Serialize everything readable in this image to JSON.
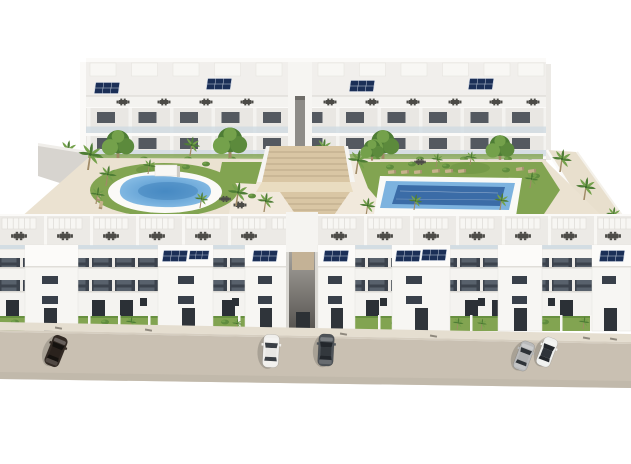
{
  "meta": {
    "image_type": "3d-architectural-render",
    "subject": "Aerial view of a white modern residential apartment complex with communal courtyard, two swimming pools, palm trees, rooftop solar panels and a street with parked cars",
    "text_visible": false
  },
  "colors": {
    "background": "#ffffff",
    "building": "#f4f3f0",
    "buildingShade": "#e7e5e1",
    "windowDark": "#3a4149",
    "glassRail": "#cdd9e2",
    "solarPanel": "#1b2f57",
    "furniture": "#4c4b47",
    "sand": "#ebe2d1",
    "lawn": "#82a451",
    "palm": "#4e7d35",
    "palmLight": "#74a14b",
    "trunk": "#a08a66",
    "poolLight": "#8fc2e8",
    "poolMid": "#4f93cc",
    "poolDeep": "#2f5f9e",
    "stairs": "#d9c6a4",
    "road": "#c9c0b2",
    "sidewalk": "#e5ded0",
    "carDarkBrown": "#332a24",
    "carWhite": "#f0efec",
    "carGrey": "#4e5358",
    "carSilver": "#b9babb"
  },
  "scene": {
    "rear_building": {
      "floors": 3,
      "roof": "rooftop terraces with pergolas, dark outdoor furniture sets and 4 solar panel clusters",
      "facade": "white with glass balustrade balconies and dark ribbon windows",
      "base": "hedge row, round trees and palm trees",
      "central_opening": "entrance gap aligned with courtyard staircase"
    },
    "courtyard": {
      "ground": "sand-beige paving with green lawns",
      "pools": [
        {
          "name": "left-pool",
          "shape": "freeform oval",
          "water": "light blue"
        },
        {
          "name": "right-pool",
          "shape": "rectangular",
          "water": "deep blue with light rim",
          "sun_loungers": 8
        }
      ],
      "central_staircase": "wide tan terraced steps connecting rear building to front passage",
      "vegetation": "many palm trees, bushes and lawn patches",
      "pool_bar": 1
    },
    "front_buildings": {
      "blocks": 2,
      "separated_by": "central pedestrian passage",
      "floors": 3,
      "roof": "courtyard-facing terraces with pergolas and furniture",
      "stair_towers_with_solar_panels": 6,
      "street_facade": "white with two dark ribbon-window bands and recessed doorways",
      "street_level": "private patios with grass, small palms and white fences"
    },
    "street": {
      "surface": "beige asphalt with sidewalk and curb",
      "cars": [
        {
          "color": "dark brown",
          "position": "left",
          "orientation": "diagonal"
        },
        {
          "color": "white",
          "position": "center-left",
          "orientation": "vertical"
        },
        {
          "color": "dark grey",
          "position": "center",
          "orientation": "vertical"
        },
        {
          "color": "silver",
          "position": "right pair",
          "orientation": "diagonal"
        },
        {
          "color": "white with dark roof",
          "position": "right pair",
          "orientation": "diagonal"
        }
      ]
    }
  }
}
